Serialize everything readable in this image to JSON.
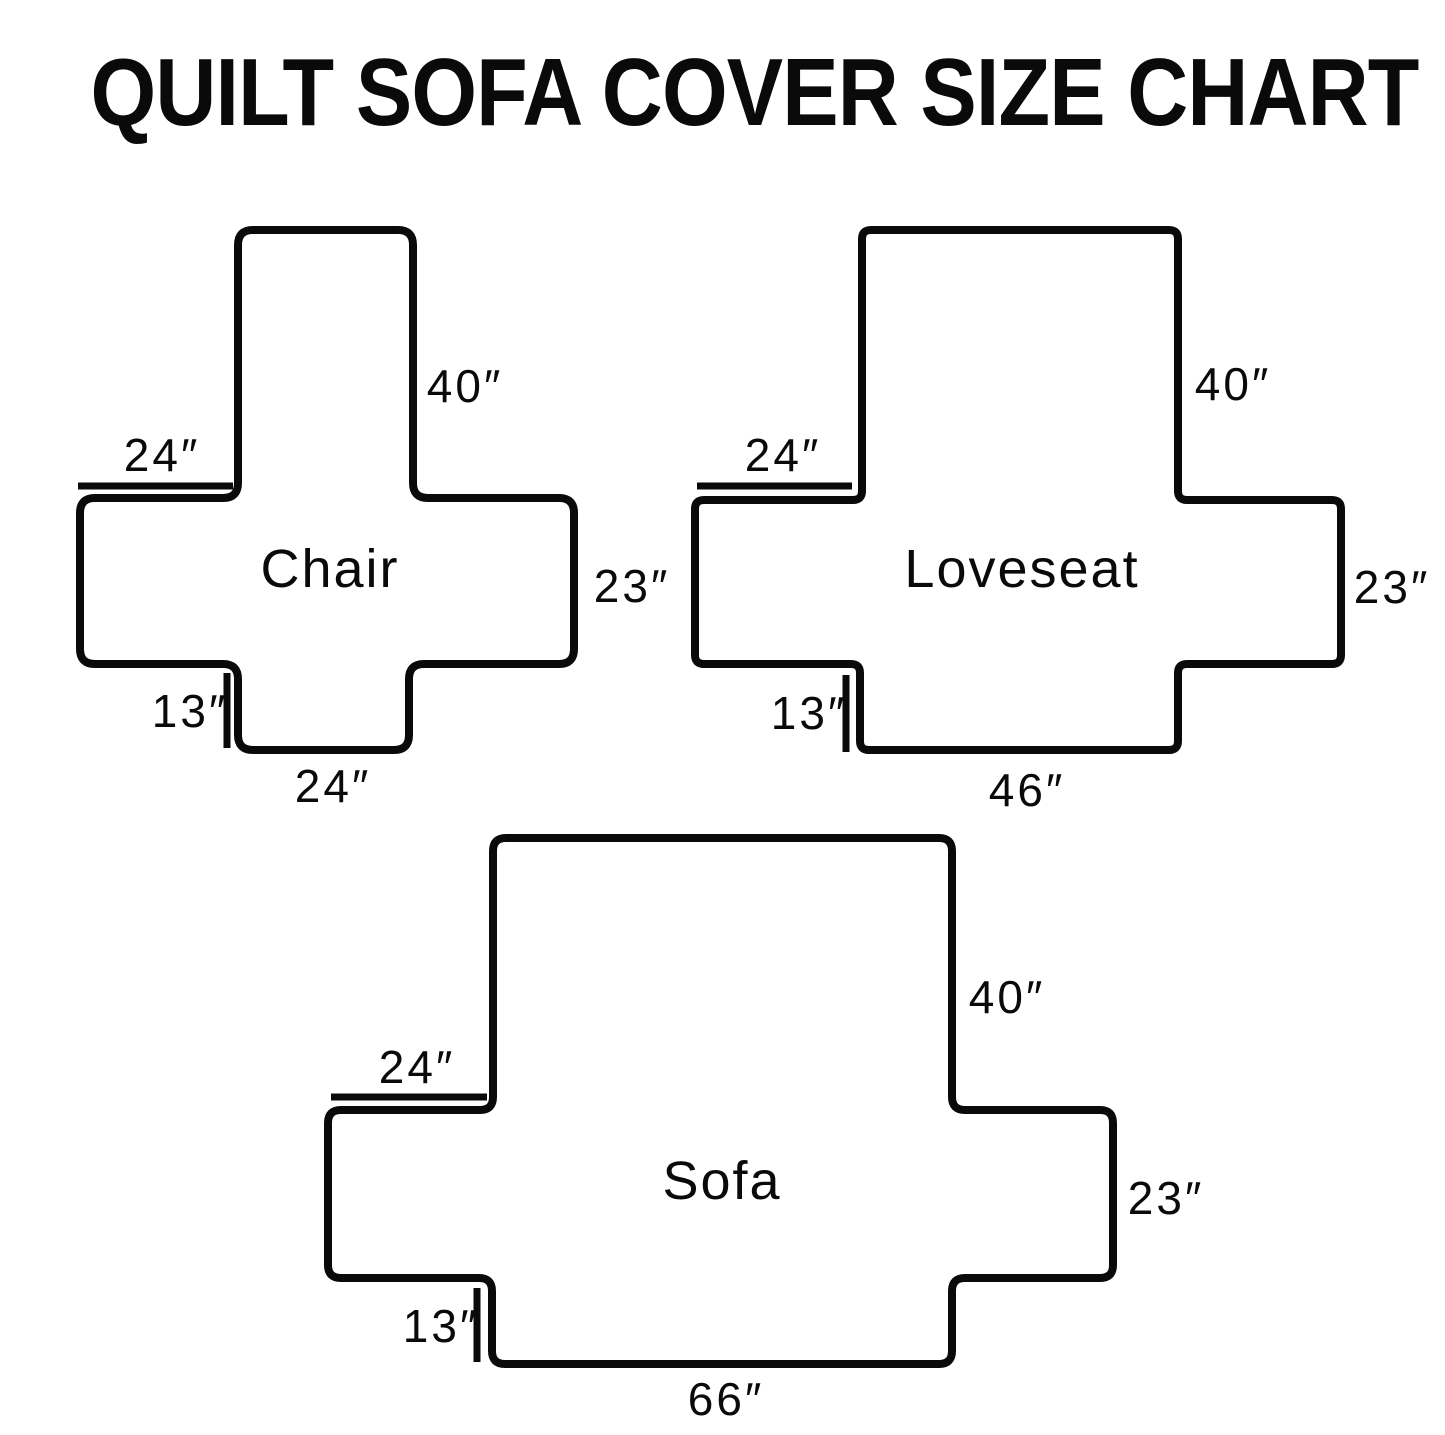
{
  "title": "QUILT SOFA COVER SIZE CHART",
  "colors": {
    "line": "#0a0a0a",
    "background": "#ffffff"
  },
  "diagrams": [
    {
      "name": "Chair",
      "back_height": "40″",
      "arm_top_width": "24″",
      "arm_side_height": "23″",
      "skirt_height": "13″",
      "seat_width": "24″"
    },
    {
      "name": "Loveseat",
      "back_height": "40″",
      "arm_top_width": "24″",
      "arm_side_height": "23″",
      "skirt_height": "13″",
      "seat_width": "46″"
    },
    {
      "name": "Sofa",
      "back_height": "40″",
      "arm_top_width": "24″",
      "arm_side_height": "23″",
      "skirt_height": "13″",
      "seat_width": "66″"
    }
  ]
}
